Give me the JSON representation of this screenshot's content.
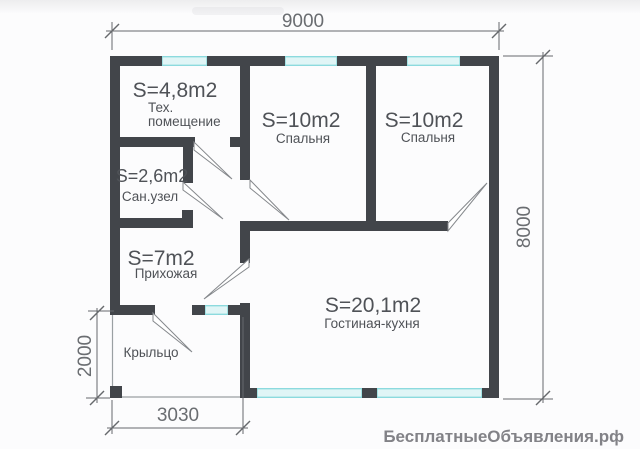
{
  "plan": {
    "rooms": [
      {
        "id": "tech-room",
        "area": "S=4,8m2",
        "name_line1": "Тех.",
        "name_line2": "помещение"
      },
      {
        "id": "bedroom-1",
        "area": "S=10m2",
        "name": "Спальня"
      },
      {
        "id": "bedroom-2",
        "area": "S=10m2",
        "name": "Спальня"
      },
      {
        "id": "bathroom",
        "area": "S=2,6m2",
        "name": "Сан.узел"
      },
      {
        "id": "entry-hall",
        "area": "S=7m2",
        "name": "Прихожая"
      },
      {
        "id": "living-kitchen",
        "area": "S=20,1m2",
        "name": "Гостиная-кухня"
      },
      {
        "id": "porch",
        "name": "Крыльцо"
      }
    ],
    "dimensions": {
      "top": "9000",
      "right": "8000",
      "left": "2000",
      "bottom": "3030"
    }
  },
  "watermark": "БесплатныеОбъявления.рф",
  "colors": {
    "wall": "#42454a",
    "window": "#e0f5f6",
    "window_edge": "#86d9dc",
    "thin_line": "#9aa0a3",
    "door_line": "#85888c",
    "dim_line": "#66696d",
    "dim_text": "#6a6d71",
    "room_text": "#4f5257",
    "watermark": "#828287"
  }
}
